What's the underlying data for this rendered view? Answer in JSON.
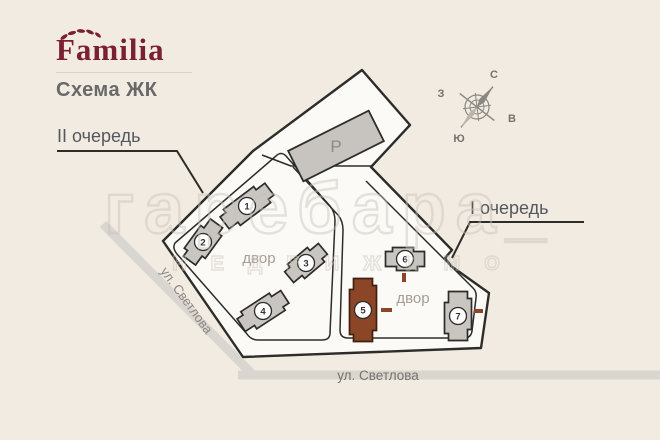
{
  "branding": {
    "logo": "Familia",
    "subtitle": "Схема ЖК",
    "logo_color": "#7b2030"
  },
  "labels": {
    "phase2": "II очередь",
    "phase1": "I очередь",
    "street_left": "ул. Светлова",
    "street_bottom": "ул. Светлова",
    "yard_left": "двор",
    "yard_right": "двор",
    "parking": "Р"
  },
  "compass": {
    "n": "С",
    "s": "Ю",
    "w": "З",
    "e": "В"
  },
  "watermark": {
    "row1": "гаребара_",
    "row2": "НЕДВИЖИМО"
  },
  "colors": {
    "background": "#f1ebe1",
    "site_fill": "#fcfaf7",
    "outline": "#2e2c29",
    "building_gray": "#c9c6c1",
    "highlight_brick": "#8b4627",
    "street_band": "#d9d5cf",
    "muted_text": "#a59e93",
    "phase_text": "#55585e"
  },
  "buildings": [
    {
      "num": "1",
      "cx": 247,
      "cy": 206,
      "w": 56,
      "h": 23,
      "rot": -37,
      "highlighted": false
    },
    {
      "num": "2",
      "cx": 203,
      "cy": 242,
      "w": 46,
      "h": 23,
      "rot": -54,
      "highlighted": false
    },
    {
      "num": "3",
      "cx": 306,
      "cy": 263,
      "w": 44,
      "h": 22,
      "rot": -40,
      "highlighted": false
    },
    {
      "num": "4",
      "cx": 263,
      "cy": 311,
      "w": 52,
      "h": 23,
      "rot": -33,
      "highlighted": false
    },
    {
      "num": "5",
      "cx": 363,
      "cy": 310,
      "w": 27,
      "h": 63,
      "rot": 0,
      "highlighted": true
    },
    {
      "num": "6",
      "cx": 405,
      "cy": 259,
      "w": 39,
      "h": 23,
      "rot": 0,
      "highlighted": false
    },
    {
      "num": "7",
      "cx": 458,
      "cy": 316,
      "w": 27,
      "h": 49,
      "rot": 0,
      "highlighted": false
    }
  ],
  "parking_building": {
    "cx": 336,
    "cy": 146,
    "w": 90,
    "h": 34,
    "rot": -26.6
  },
  "entrance_marks": [
    {
      "x": 402,
      "y": 273,
      "w": 4,
      "h": 9
    },
    {
      "x": 381,
      "y": 308,
      "w": 11,
      "h": 4
    },
    {
      "x": 474,
      "y": 309,
      "w": 9,
      "h": 4
    }
  ]
}
